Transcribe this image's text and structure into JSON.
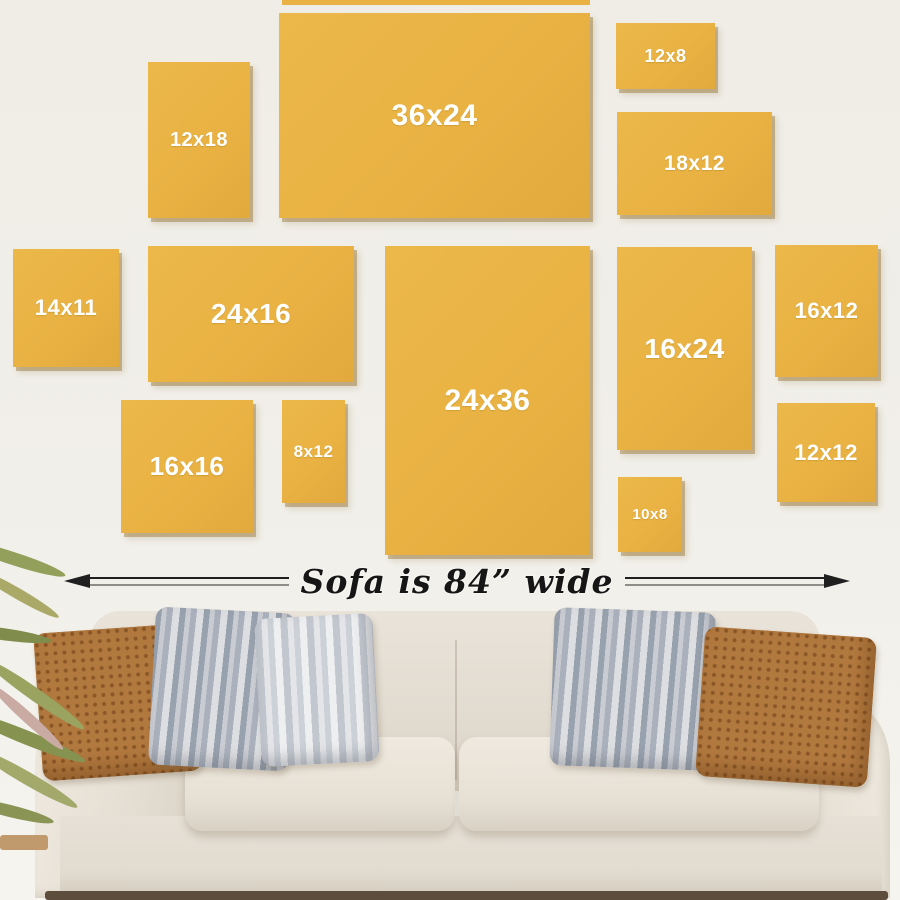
{
  "frames": [
    {
      "id": "12x18",
      "label": "12x18"
    },
    {
      "id": "36x24",
      "label": "36x24"
    },
    {
      "id": "12x8",
      "label": "12x8"
    },
    {
      "id": "18x12",
      "label": "18x12"
    },
    {
      "id": "14x11",
      "label": "14x11"
    },
    {
      "id": "24x16",
      "label": "24x16"
    },
    {
      "id": "24x36",
      "label": "24x36"
    },
    {
      "id": "16x24",
      "label": "16x24"
    },
    {
      "id": "16x12",
      "label": "16x12"
    },
    {
      "id": "16x16",
      "label": "16x16"
    },
    {
      "id": "8x12",
      "label": "8x12"
    },
    {
      "id": "10x8",
      "label": "10x8"
    },
    {
      "id": "12x12",
      "label": "12x12"
    }
  ],
  "annotation": {
    "sofa_width_text": "Sofa is 84” wide"
  },
  "colors": {
    "frame_fill": "#e9b243",
    "frame_shadow": "#946e26",
    "frame_label_text": "#ffffff",
    "wall_background": "#f1efe9",
    "arrow_line": "#1f1f1f",
    "annotation_text": "#161616",
    "sofa_fabric": "#e2dbd0",
    "pillow_rust": "#b2793f",
    "pillow_stripe_gray": "#98a1ae",
    "floor_shadow": "#5c4d3d",
    "plant_leaf": "#8a9455"
  }
}
